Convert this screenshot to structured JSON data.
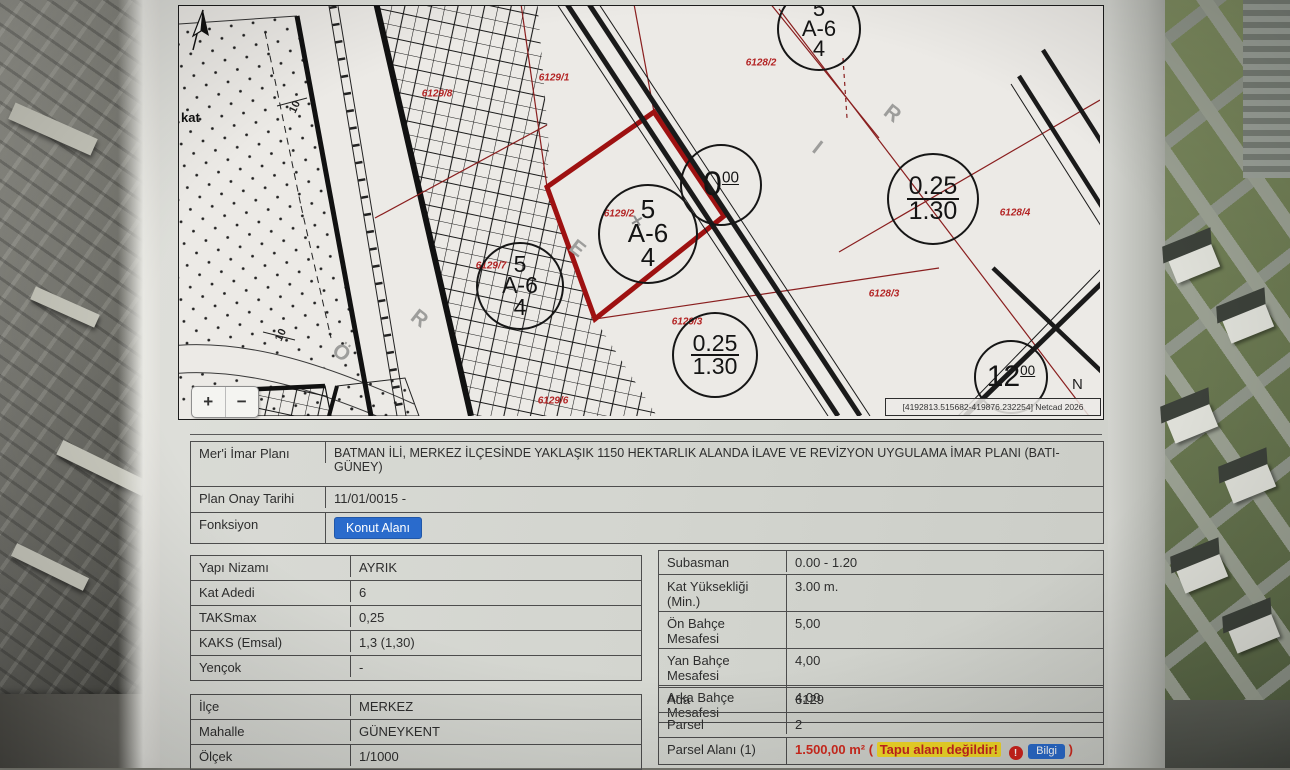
{
  "map": {
    "corner_label": "kat",
    "zoom_in": "+",
    "zoom_out": "−",
    "north_label": "N",
    "credit": "[4192813.515682-419876.232254] Netcad 2026",
    "marker": "×",
    "parcel_labels": [
      {
        "text": "6129/8"
      },
      {
        "text": "6129/1"
      },
      {
        "text": "6128/2"
      },
      {
        "text": "6128/4"
      },
      {
        "text": "6128/3"
      },
      {
        "text": "6129/3"
      },
      {
        "text": "6129/6"
      },
      {
        "text": "6129/7"
      },
      {
        "text": "6129/2"
      }
    ],
    "road_letters": [
      {
        "text": "Ö"
      },
      {
        "text": "R"
      },
      {
        "text": "E"
      },
      {
        "text": "I"
      },
      {
        "text": "R"
      }
    ],
    "dim_labels": [
      {
        "text": "10"
      },
      {
        "text": "10"
      }
    ],
    "circles": [
      {
        "top": "5",
        "mid": "A-6",
        "bot": "4"
      },
      {
        "top": "5",
        "mid": "A-6",
        "bot": "4"
      },
      {
        "top": "5",
        "mid": "A-6",
        "bot": "4"
      },
      {
        "top": "0.25",
        "bot": "1.30"
      },
      {
        "top": "0.25",
        "bot": "1.30"
      },
      {
        "main": "0",
        "sup": "00"
      },
      {
        "main": "12",
        "sup": "00"
      }
    ]
  },
  "plan_info": {
    "rows": [
      {
        "label": "Mer'i İmar Planı",
        "value": "BATMAN İLİ, MERKEZ İLÇESİNDE YAKLAŞIK 1150 HEKTARLIK ALANDA İLAVE VE REVİZYON UYGULAMA İMAR PLANI (BATI-GÜNEY)"
      },
      {
        "label": "Plan Onay Tarihi",
        "value": "11/01/0015 -"
      }
    ],
    "fonksiyon_label": "Fonksiyon",
    "fonksiyon_value": "Konut Alanı"
  },
  "building_rules": {
    "rows": [
      {
        "label": "Yapı Nizamı",
        "value": "AYRIK"
      },
      {
        "label": "Kat Adedi",
        "value": "6"
      },
      {
        "label": "TAKSmax",
        "value": "0,25"
      },
      {
        "label": "KAKS (Emsal)",
        "value": "1,3 (1,30)"
      },
      {
        "label": "Yençok",
        "value": "-"
      }
    ]
  },
  "setbacks": {
    "rows": [
      {
        "label": "Subasman",
        "value": "0.00 - 1.20"
      },
      {
        "label": "Kat Yüksekliği (Min.)",
        "value": "3.00 m."
      },
      {
        "label": "Ön Bahçe Mesafesi",
        "value": "5,00"
      },
      {
        "label": "Yan Bahçe Mesafesi",
        "value": "4,00"
      },
      {
        "label": "Arka Bahçe Mesafesi",
        "value": "4,00"
      }
    ]
  },
  "location": {
    "rows": [
      {
        "label": "İlçe",
        "value": "MERKEZ"
      },
      {
        "label": "Mahalle",
        "value": "GÜNEYKENT"
      },
      {
        "label": "Ölçek",
        "value": "1/1000"
      }
    ]
  },
  "parcel": {
    "rows": [
      {
        "label": "Ada",
        "value": "6129"
      },
      {
        "label": "Parsel",
        "value": "2"
      }
    ],
    "area_label": "Parsel Alanı (1)",
    "area_value": "1.500,00 m²",
    "paren_open": "(",
    "warning": "Tapu alanı değildir!",
    "info_icon": "!",
    "info_button": "Bilgi",
    "paren_close": ")"
  },
  "colors": {
    "accent_blue": "#2a6bcc",
    "warning_bg": "#f2d928",
    "warning_text": "#c6231f",
    "area_red": "#d02a1e",
    "selected_parcel_red": "#9e1111",
    "map_label_red": "#b32424"
  }
}
